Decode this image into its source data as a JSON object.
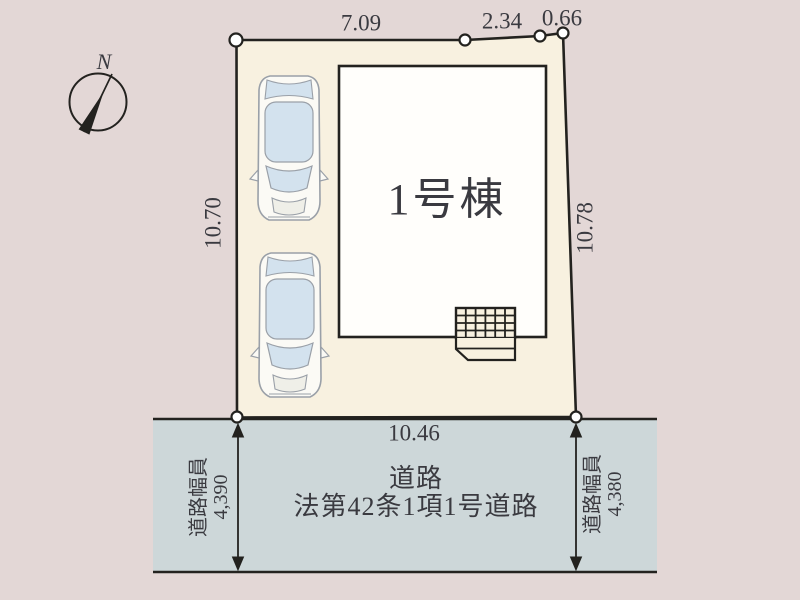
{
  "colors": {
    "background": "#e3d7d6",
    "lot_fill": "#f8f1e0",
    "building_fill": "#fffefb",
    "road_fill": "#cdd7d9",
    "outline": "#23221f",
    "text_color": "#3a3a40",
    "car_body": "#fbfaf5",
    "car_outline": "#9aa0a8",
    "car_window": "#d3e2ee"
  },
  "compass": {
    "north_label": "N"
  },
  "lot": {
    "building_label": "1号棟",
    "dim_top_1": "7.09",
    "dim_top_2": "2.34",
    "dim_top_3": "0.66",
    "dim_left": "10.70",
    "dim_right": "10.78",
    "dim_bottom": "10.46"
  },
  "road": {
    "name_line1": "道路",
    "name_line2": "法第42条1項1号道路",
    "left_width": {
      "label": "道路幅員",
      "value": "4,390"
    },
    "right_width": {
      "label": "道路幅員",
      "value": "4,380"
    }
  }
}
